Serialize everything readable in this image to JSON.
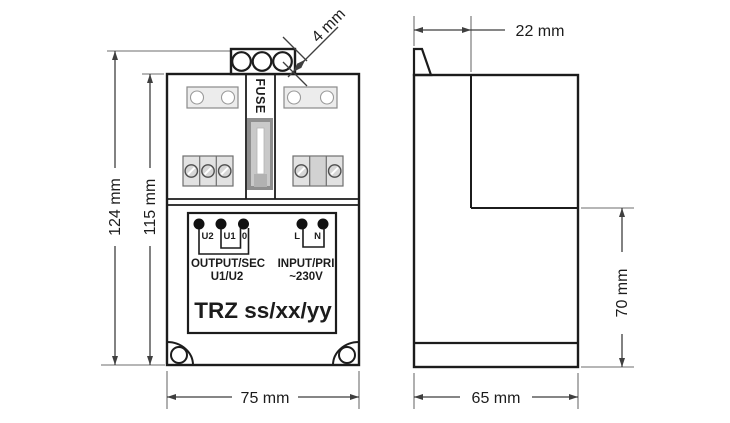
{
  "front_view": {
    "fuse_label": "FUSE",
    "terminal_labels": [
      "U2",
      "U1",
      "0",
      "L",
      "N"
    ],
    "output_label": "OUTPUT/SEC",
    "output_sub_label": "U1/U2",
    "input_label": "INPUT/PRI",
    "input_voltage": "~230V",
    "model": "TRZ ss/xx/yy"
  },
  "dimensions": {
    "overall_height": "124 mm",
    "body_height": "115 mm",
    "front_width": "75 mm",
    "knockout": "4 mm",
    "terminal_depth": "22 mm",
    "lower_section_height": "70 mm",
    "total_depth": "65 mm"
  },
  "colors": {
    "background": "#ffffff",
    "line": "#1c1c1c",
    "dim_line": "#3f3f3f",
    "ext_line": "#6e6e6e",
    "plate_fill": "#ececec",
    "plate_stroke": "#8a8a8a",
    "block_fill": "#e2e2e2",
    "block_stroke": "#6f6f6f",
    "screw_fill": "#d7d7d7",
    "cell_shaded": "#d2d2d2",
    "fuse_holder": "#8f8f8f",
    "fuse_inner": "#c9c9c9",
    "fuse_cap": "#b2b2b2",
    "dot": "#111111"
  }
}
